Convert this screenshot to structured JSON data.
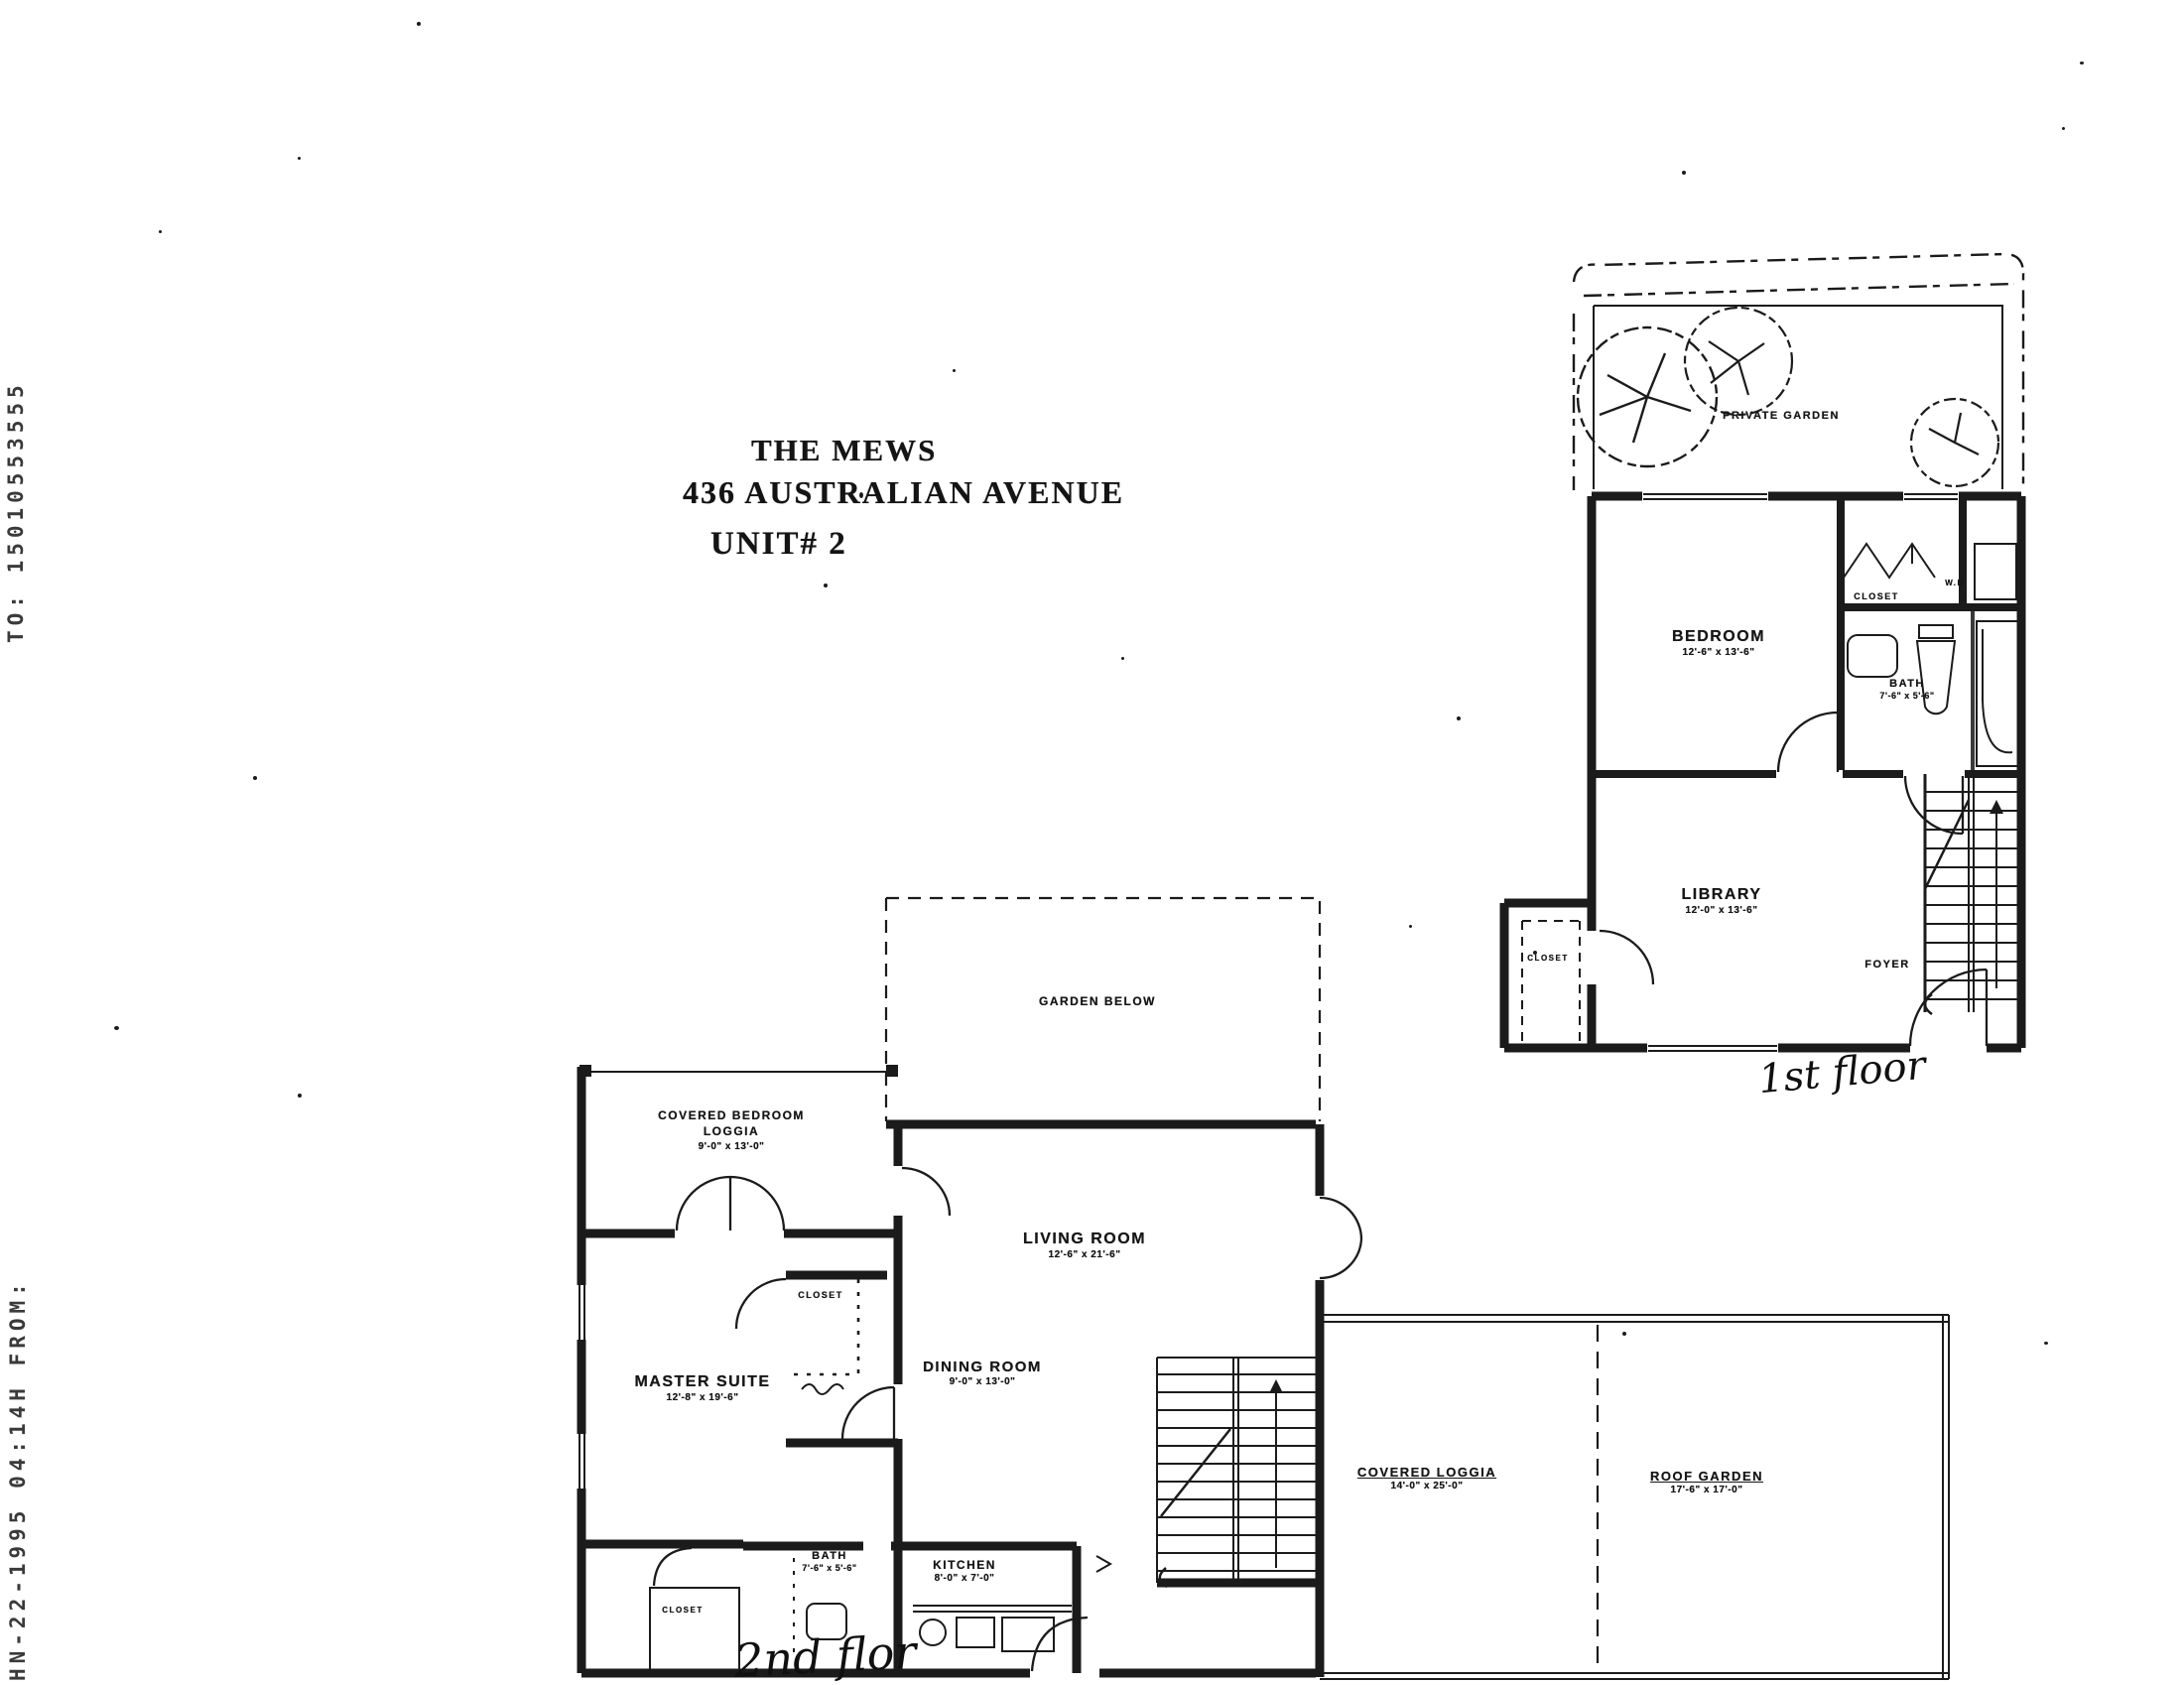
{
  "colors": {
    "ink": "#1b1b1b",
    "paper": "#ffffff"
  },
  "fax": {
    "top_vertical": "TO: 15010553555",
    "bottom_vertical": "HN-22-1995 04:14H FROM:"
  },
  "title": {
    "line1": "THE MEWS",
    "line2": "436 AUSTRALIAN AVENUE",
    "line3": "UNIT# 2"
  },
  "floor1": {
    "handwritten_note": "1st floor",
    "rooms": {
      "private_garden": {
        "name": "PRIVATE GARDEN"
      },
      "bedroom": {
        "name": "BEDROOM",
        "dim": "12'-6\" x 13'-6\""
      },
      "closet": {
        "name": "CLOSET"
      },
      "washer_dryer": {
        "name": "W.D"
      },
      "bath": {
        "name": "BATH",
        "dim": "7'-6\" x 5'-6\""
      },
      "library": {
        "name": "LIBRARY",
        "dim": "12'-0\" x 13'-6\""
      },
      "foyer": {
        "name": "FOYER"
      },
      "closet2": {
        "name": "CLOSET"
      }
    }
  },
  "floor2": {
    "handwritten_note": "2nd flor",
    "rooms": {
      "garden_below": {
        "name": "GARDEN BELOW"
      },
      "covered_bedroom_loggia": {
        "name": "COVERED BEDROOM LOGGIA",
        "dim": "9'-0\" x 13'-0\""
      },
      "living_room": {
        "name": "LIVING ROOM",
        "dim": "12'-6\" x 21'-6\""
      },
      "master_suite": {
        "name": "MASTER SUITE",
        "dim": "12'-8\" x 19'-6\""
      },
      "dining_room": {
        "name": "DINING ROOM",
        "dim": "9'-0\" x 13'-0\""
      },
      "closet_hall": {
        "name": "CLOSET"
      },
      "bath": {
        "name": "BATH",
        "dim": "7'-6\" x 5'-6\""
      },
      "kitchen": {
        "name": "KITCHEN",
        "dim": "8'-0\" x 7'-0\""
      },
      "closet_lower": {
        "name": "CLOSET"
      },
      "covered_loggia": {
        "name": "COVERED LOGGIA",
        "dim": "14'-0\" x 25'-0\""
      },
      "roof_garden": {
        "name": "ROOF GARDEN",
        "dim": "17'-6\" x 17'-0\""
      }
    }
  }
}
